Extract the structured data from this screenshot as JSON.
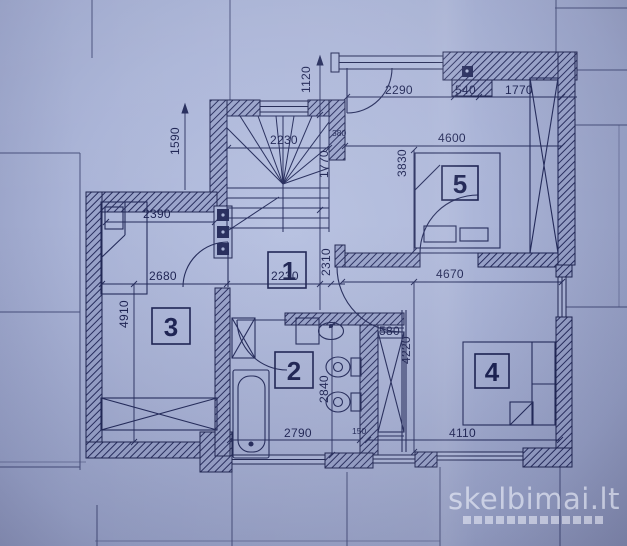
{
  "watermark": {
    "text": "skelbimai.lt"
  },
  "rooms": {
    "hall": "1",
    "bathroom": "2",
    "room3": "3",
    "room4": "4",
    "room5": "5"
  },
  "dims": {
    "v1590": "1590",
    "v1120": "1120",
    "v1770_stair": "1770",
    "v2310": "2310",
    "v3830": "3830",
    "v4910": "4910",
    "v2840": "2840",
    "v4220": "4220",
    "h2290": "2290",
    "h540": "540",
    "h1770_top": "1770",
    "h4600": "4600",
    "h2230_stair": "2230",
    "h2390": "2390",
    "h2680": "2680",
    "h2230_hall": "2230",
    "h4670": "4670",
    "h580": "580",
    "h2790": "2790",
    "h4110": "4110",
    "s150": "150",
    "s380": "380"
  },
  "colors": {
    "paper": "#aab4d7",
    "ink": "#1e2450",
    "wall_fill": "#99a3ca",
    "watermark": "#eef1fa"
  }
}
